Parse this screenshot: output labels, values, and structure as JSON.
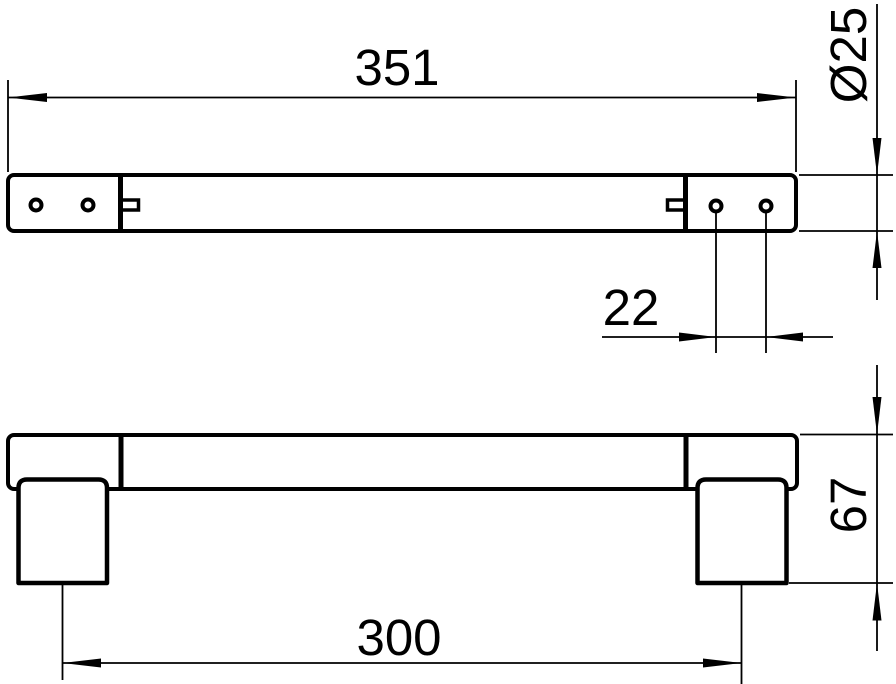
{
  "drawing": {
    "background_color": "#ffffff",
    "line_color": "#000000",
    "dimensions": {
      "overall_length": "351",
      "bar_diameter": "Ø25",
      "hole_spacing": "22",
      "projection": "67",
      "mounting_centers": "300"
    }
  }
}
